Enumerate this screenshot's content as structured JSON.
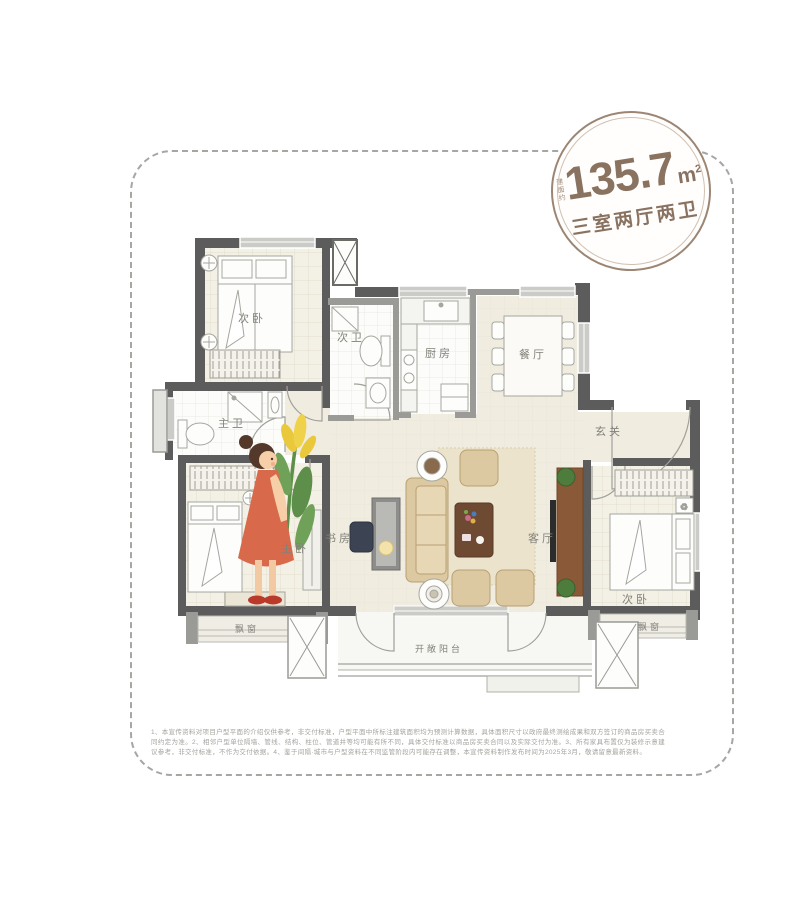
{
  "badge": {
    "area_prefix": "建面约",
    "area_value": "135.7",
    "area_unit": "m",
    "area_unit_sup": "2",
    "layout_type": "三室两厅两卫",
    "accent_color": "#9c8673"
  },
  "rooms": {
    "bedroom_top_left": "次卧",
    "bath_second": "次卫",
    "kitchen": "厨房",
    "dining": "餐厅",
    "bath_master": "主卫",
    "foyer": "玄关",
    "study": "书房",
    "living": "客厅",
    "bedroom_master": "主卧",
    "bedroom_right": "次卧",
    "bay_window_left": "飘窗",
    "bay_window_right": "飘窗",
    "balcony": "开敞阳台"
  },
  "palette": {
    "wall_dark": "#5c5c5c",
    "wall_light": "#9a9a96",
    "floor_beige": "#f0ece0",
    "floor_bedroom": "#f3f0e6",
    "sofa_tan": "#dcc9a1",
    "wood_brown": "#8a5a38",
    "girl_dress": "#d8694a"
  },
  "disclaimer": "1、本宣传资料对项目户型平面的介绍仅供参考，非交付标准，户型平面中所标注建筑面积均为预测计算数据，具体面积尺寸以政府最终测绘成果和双方签订的商品房买卖合同约定为准。2、相邻户型单位隔墙、管线、结构、柱位、管道井等均可能有所不同，具体交付标准以商品房买卖合同以及实际交付为准。3、所有家具布置仅为装修示意建议参考，非交付标准，不作为交付依据。4、鉴于间隔·城市与户型资料在不同监管阶段内可能存在调整，本宣传资料制作发布时间为2025年3月，敬请留意最新资料。"
}
